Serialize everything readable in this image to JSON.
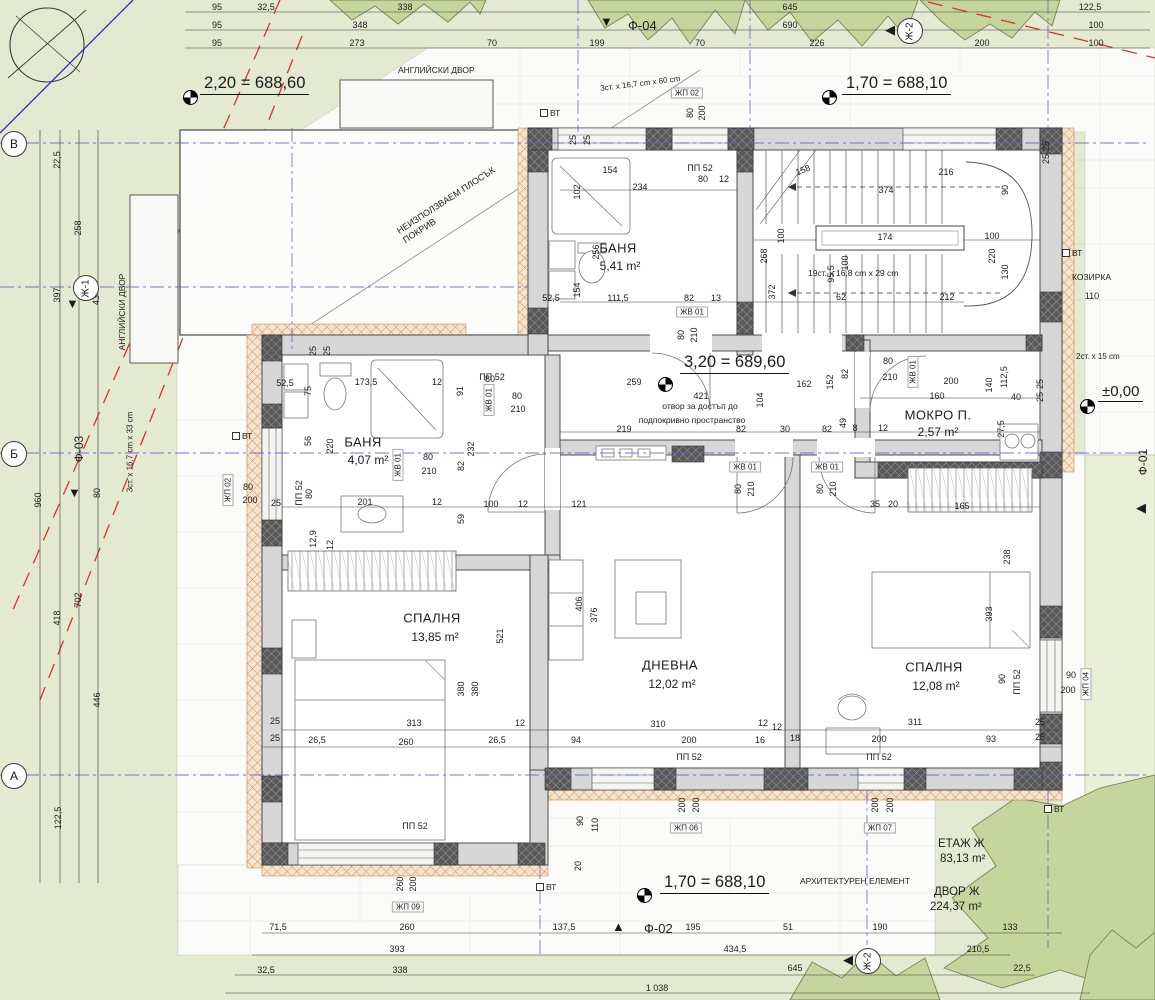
{
  "rooms": {
    "bath_top": {
      "name": "БАНЯ",
      "area": "5,41 m²"
    },
    "bath_left": {
      "name": "БАНЯ",
      "area": "4,07 m²"
    },
    "wet_room": {
      "name": "МОКРО П.",
      "area": "2,57 m²"
    },
    "bedroom_left": {
      "name": "СПАЛНЯ",
      "area": "13,85 m²"
    },
    "living": {
      "name": "ДНЕВНА",
      "area": "12,02 m²"
    },
    "bedroom_right": {
      "name": "СПАЛНЯ",
      "area": "12,08 m²"
    }
  },
  "elevations": {
    "top_left": "2,20 = 688,60",
    "top_right": "1,70 = 688,10",
    "center": "3,20 = 689,60",
    "zero": "±0,00",
    "bottom": "1,70 = 688,10"
  },
  "areas": {
    "floor_label": "ЕТАЖ Ж",
    "floor_area": "83,13 m²",
    "yard_label": "ДВОР Ж",
    "yard_area": "224,37 m²"
  },
  "annotations": {
    "english_yard": "АНГЛИЙСКИ ДВОР",
    "flat_roof_1": "НЕИЗПОЛЗВАЕМ ПЛОСЪК",
    "flat_roof_2": "ПОКРИВ",
    "canopy": "КОЗИРКА",
    "attic_1": "отвор за достъп до",
    "attic_2": "подпокривно пространство",
    "arch_element": "АРХИТЕКТУРЕН ЕЛЕМЕНТ",
    "stair_main": "19ст. x 16,8 cm x 29 cm",
    "stair_top": "3ст. x 16,7 cm x 60 cm",
    "stair_left": "3ст. x 16,7 cm x 33 cm",
    "stair_right": "2ст. x 15 cm",
    "vt": "ВТ"
  },
  "grid": {
    "row_v": "В",
    "row_b": "Б",
    "row_a": "А",
    "j1": "Ж-1",
    "j2": "Ж-2",
    "f01": "Ф-01",
    "f02": "Ф-02",
    "f03": "Ф-03",
    "f04": "Ф-04"
  },
  "tags": {
    "jp02": "ЖП 02",
    "jp04": "ЖП 04",
    "jp06": "ЖП 06",
    "jp07": "ЖП 07",
    "jp09": "ЖП 09",
    "jv01": "ЖВ 01",
    "pp52": "ПП 52"
  },
  "tag_sizes": {
    "s80": "80",
    "s200": "200",
    "s210": "210",
    "s90": "90",
    "s260": "260",
    "s12": "12"
  },
  "dims": {
    "top1": [
      "95",
      "32,5",
      "338",
      "645",
      "122,5"
    ],
    "top2": [
      "95",
      "348",
      "690",
      "100"
    ],
    "top3": [
      "95",
      "273",
      "70",
      "199",
      "70",
      "226",
      "200",
      "100"
    ],
    "left": [
      "22,5",
      "258",
      "397",
      "43",
      "960",
      "80",
      "418",
      "702",
      "446",
      "122,5"
    ],
    "bottom1": [
      "71,5",
      "260",
      "137,5",
      "195",
      "51",
      "190",
      "133"
    ],
    "bottom2": [
      "393",
      "434,5",
      "210,5"
    ],
    "bottom3": [
      "32,5",
      "338",
      "645",
      "22,5"
    ],
    "total": "1 038",
    "inner": [
      "154",
      "234",
      "102",
      "256",
      "154",
      "52,5",
      "111,5",
      "82",
      "13",
      "216",
      "374",
      "158",
      "100",
      "174",
      "100",
      "90",
      "220",
      "130",
      "95,5",
      "100",
      "62",
      "212",
      "268",
      "372",
      "259",
      "421",
      "162",
      "104",
      "152",
      "82",
      "219",
      "82",
      "30",
      "82",
      "8",
      "12",
      "49",
      "200",
      "160",
      "140",
      "112,5",
      "40",
      "27,5",
      "35",
      "20",
      "165",
      "238",
      "52,5",
      "75",
      "173,5",
      "12",
      "56",
      "220",
      "80",
      "201",
      "12",
      "25",
      "91",
      "82",
      "232",
      "59",
      "100",
      "12",
      "121",
      "80",
      "12,9",
      "12",
      "521",
      "380",
      "380",
      "313",
      "260",
      "26,5",
      "26,5",
      "12",
      "25",
      "25",
      "406",
      "376",
      "310",
      "200",
      "94",
      "16",
      "12",
      "12",
      "18",
      "393",
      "90",
      "311",
      "200",
      "93",
      "90",
      "110",
      "20",
      "110",
      "25",
      "25",
      "25",
      "25",
      "25",
      "25",
      "25",
      "25",
      "25",
      "25"
    ]
  }
}
